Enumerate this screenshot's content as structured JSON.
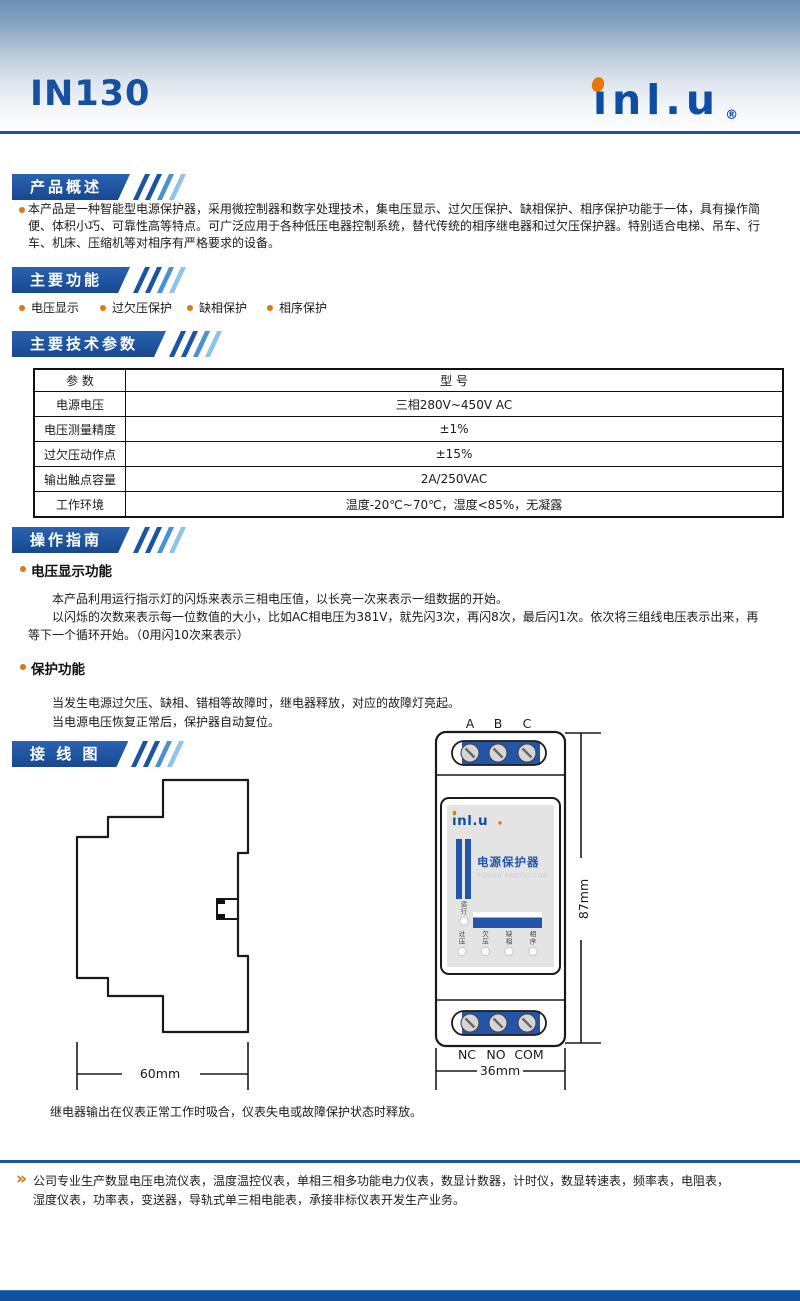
{
  "page": {
    "model": "IN130",
    "brand": {
      "logo_text": "ınl.u",
      "registered": "®"
    }
  },
  "sections": {
    "overview": {
      "title": "产品概述",
      "body": "本产品是一种智能型电源保护器，采用微控制器和数字处理技术，集电压显示、过欠压保护、缺相保护、相序保护功能于一体，具有操作简便、体积小巧、可靠性高等特点。可广泛应用于各种低压电器控制系统，替代传统的相序继电器和过欠压保护器。特别适合电梯、吊车、行车、机床、压缩机等对相序有严格要求的设备。"
    },
    "features": {
      "title": "主要功能",
      "items": [
        "电压显示",
        "过欠压保护",
        "缺相保护",
        "相序保护"
      ]
    },
    "specs": {
      "title": "主要技术参数",
      "table": {
        "header": [
          "参  数",
          "型  号"
        ],
        "rows": [
          [
            "电源电压",
            "三相280V~450V AC"
          ],
          [
            "电压测量精度",
            "±1%"
          ],
          [
            "过欠压动作点",
            "±15%"
          ],
          [
            "输出触点容量",
            "2A/250VAC"
          ],
          [
            "工作环境",
            "温度-20℃~70℃，湿度<85%，无凝露"
          ]
        ]
      }
    },
    "operation": {
      "title": "操作指南",
      "voltage_display": {
        "heading": "电压显示功能",
        "para1": "本产品利用运行指示灯的闪烁来表示三相电压值，以长亮一次来表示一组数据的开始。",
        "para2": "以闪烁的次数来表示每一位数值的大小，比如AC相电压为381V，就先闪3次，再闪8次，最后闪1次。依次将三组线电压表示出来，再等下一个循环开始。（0用闪10次来表示）"
      },
      "protection": {
        "heading": "保护功能",
        "line1": "当发生电源过欠压、缺相、错相等故障时，继电器释放，对应的故障灯亮起。",
        "line2": "当电源电压恢复正常后，保护器自动复位。"
      }
    },
    "wiring": {
      "title": "接 线 图",
      "note": "继电器输出在仪表正常工作时吸合，仪表失电或故障保护状态时释放。",
      "device": {
        "top_terminals": [
          "A",
          "B",
          "C"
        ],
        "bottom_terminals": [
          "NC",
          "NO",
          "COM"
        ],
        "width_label": "36mm",
        "height_label": "87mm",
        "depth_label": "60mm",
        "product_name": "电源保护器",
        "product_name_en": "POWER PROTECTOR",
        "run_led": "运行",
        "status_leds": [
          "过压",
          "欠压",
          "缺相",
          "相序"
        ]
      }
    }
  },
  "footer": {
    "chevron": "»",
    "text": "公司专业生产数显电压电流仪表，温度温控仪表，单相三相多功能电力仪表，数显计数器，计时仪，数显转速表，频率表，电阻表，湿度仪表，功率表，变送器，导轨式单三相电能表，承接非标仪表开发生产业务。"
  },
  "colors": {
    "brand_blue": "#17509e",
    "accent_orange": "#e87313",
    "device_blue": "#2356a8"
  }
}
